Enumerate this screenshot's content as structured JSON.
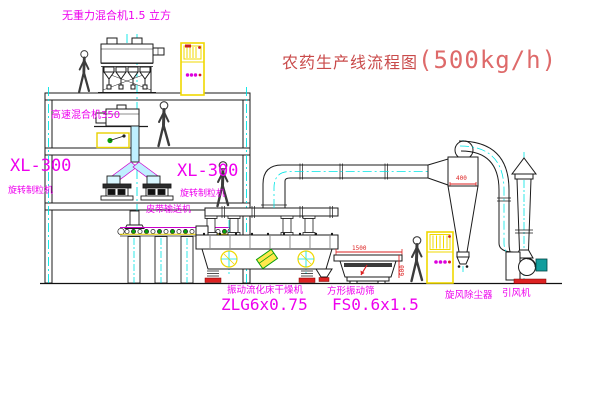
{
  "title": {
    "name_cn": "农药生产线流程图",
    "capacity": "(500kg/h)"
  },
  "labels": {
    "gravity_mixer": "无重力混合机1.5 立方",
    "high_speed_mixer": "高速混合机350",
    "granulator_model_left": "XL-300",
    "granulator_name_left": "旋转制粒机",
    "granulator_model_mid": "XL-300",
    "granulator_name_mid": "旋转制粒机",
    "belt_conveyor": "皮带输送机",
    "dryer_name": "振动流化床干燥机",
    "dryer_model": "ZLG6x0.75",
    "sieve_name": "方形振动筛",
    "sieve_model": "FS0.6x1.5",
    "cyclone": "旋风除尘器",
    "fan": "引风机"
  },
  "dimensions": {
    "sieve_length": "1500",
    "sieve_height": "600",
    "cyclone_dia": "400"
  },
  "colors": {
    "label_magenta": "#ee00ee",
    "title_red": "#d65c5c",
    "centerline_cyan": "#00e5e5",
    "cabinet_yellow": "#f0d800",
    "line_black": "#1b1b1b",
    "accent_red": "#dd2222",
    "accent_green": "#0aa00a",
    "motor_teal": "#129d9d"
  }
}
